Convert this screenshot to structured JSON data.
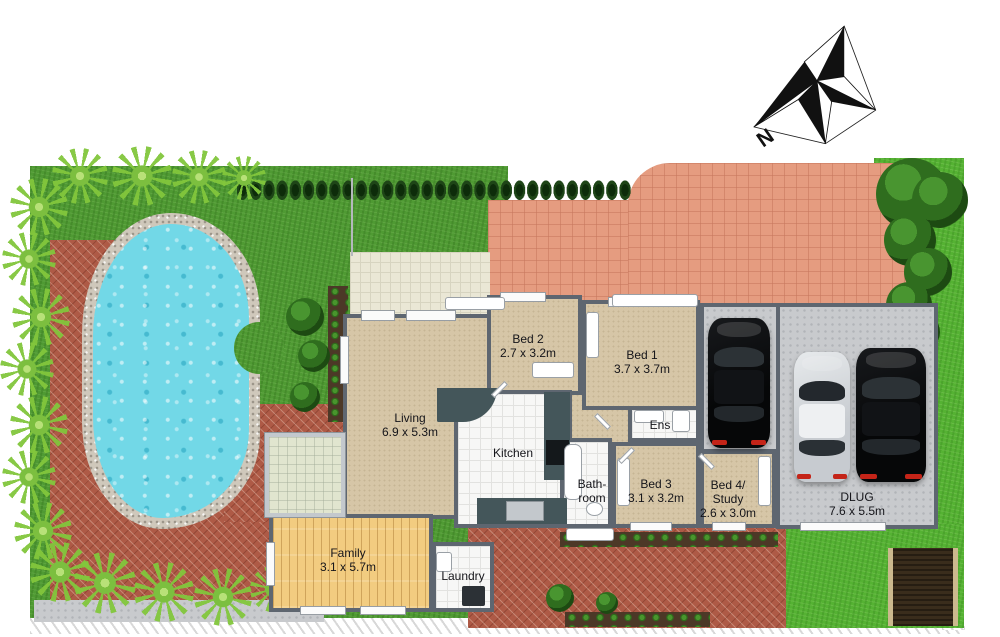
{
  "compass": {
    "label": "N"
  },
  "rooms": {
    "living": {
      "name": "Living",
      "dims": "6.9 x 5.3m"
    },
    "kitchen": {
      "name": "Kitchen"
    },
    "bed1": {
      "name": "Bed 1",
      "dims": "3.7 x 3.7m"
    },
    "bed2": {
      "name": "Bed 2",
      "dims": "2.7 x 3.2m"
    },
    "bed3": {
      "name": "Bed 3",
      "dims": "3.1 x 3.2m"
    },
    "bed4": {
      "line1": "Bed 4/",
      "line2": "Study",
      "dims": "2.6 x 3.0m"
    },
    "ens": {
      "name": "Ens"
    },
    "bathroom": {
      "line1": "Bath-",
      "line2": "room"
    },
    "laundry": {
      "name": "Laundry"
    },
    "family": {
      "name": "Family",
      "dims": "3.1 x 5.7m"
    },
    "garage": {
      "name": "DLUG",
      "dims": "7.6 x 5.5m"
    }
  },
  "colors": {
    "lawn": "#4f9a33",
    "lawn_bright": "#55b233",
    "brick_paving": "#ae5a46",
    "driveway_paving": "#e59c80",
    "patio_tile": "#eae7d5",
    "carpet": "#d6c6a7",
    "timber_floor": "#f2cc80",
    "wet_area_tile": "#f7f7f6",
    "wall": "#5e6670",
    "pool_water": "#72d8e7",
    "pool_edge": "#cfc8bb",
    "hedge": "#1e4517"
  }
}
